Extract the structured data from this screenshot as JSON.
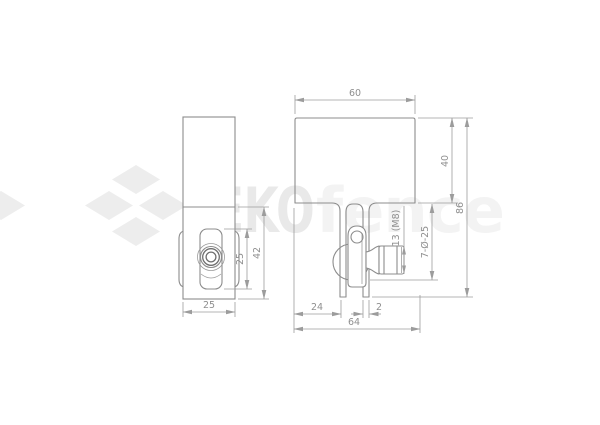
{
  "watermark": {
    "brand_bold": "EKO",
    "brand_light": "fence",
    "logo_color": "#ededed",
    "brand_bold_color": "#e9e9e9",
    "brand_light_color": "#f3f3f3"
  },
  "drawing": {
    "background_color": "#ffffff",
    "outline_color": "#8c8c8c",
    "dimension_color": "#9c9c9c",
    "side_view": {
      "dims": {
        "slot_height": "25",
        "lower_section_height": "42",
        "width": "25"
      }
    },
    "front_view": {
      "dims": {
        "top_width": "60",
        "plate_height": "40",
        "overall_height": "86",
        "bolt_head": "13 (M8)",
        "clamp": "7-Ø-25",
        "left_leg_offset": "24",
        "leg_thickness": "2",
        "overall_width": "64"
      }
    }
  }
}
